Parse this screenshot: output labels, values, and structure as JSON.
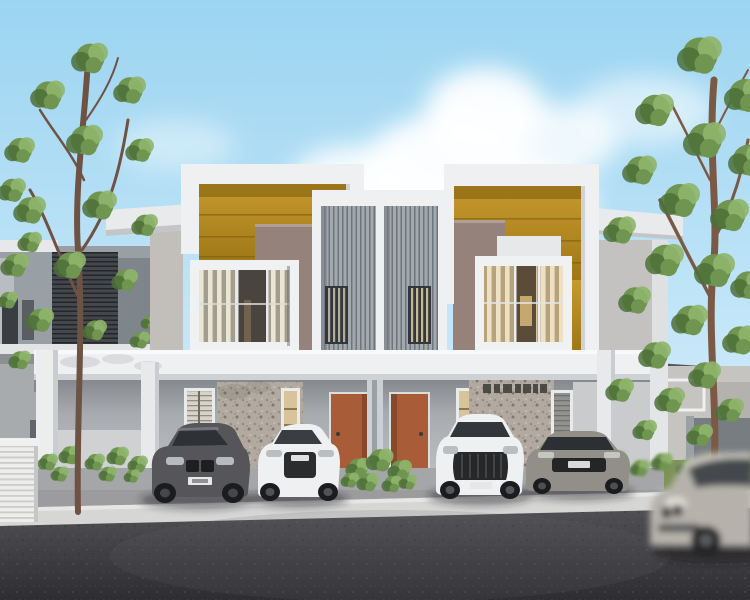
{
  "meta": {
    "subject": "3D architectural rendering of a modern two-storey terrace duplex with gold parapet accents, central vertical louver screens, four parked cars and a motion-blurred passing car",
    "setting": "daytime, blue sky with cumulus cloud, trees flanking both sides, asphalt street in foreground"
  },
  "palette": {
    "sky_top": "#9bd4f1",
    "sky_mid": "#c4e6f8",
    "sky_horizon": "#e4f1fb",
    "cloud": "#ffffff",
    "gold_accent": "#bb8d22",
    "gold_shadow": "#8a6712",
    "taupe_wall": "#95827a",
    "taupe_dark": "#7c6c64",
    "white_wall": "#eff0f2",
    "white_shadow": "#cfd2d5",
    "louver_light": "#a2a9af",
    "louver_dark": "#6e767d",
    "stone_wall": "#b2aaa0",
    "porch_wall": "#a7abaf",
    "porch_shadow": "#85898e",
    "door": "#a85c38",
    "door_shade": "#7e4527",
    "window_glass": "#4d5257",
    "curtain_warm": "#e8dcc0",
    "foliage": "#6f9550",
    "foliage_dark": "#4e7038",
    "foliage_light": "#8fb56c",
    "trunk": "#6e5244",
    "driveway": "#9c9c9e",
    "curb": "#d6d6d4",
    "asphalt_light": "#515155",
    "asphalt_dark": "#2e2e32",
    "car_dark_gray": "#55555a",
    "car_white": "#eef0f2",
    "car_silver": "#918f88",
    "car_blur_silver": "#b6b2ab",
    "tyre": "#1b1c1f",
    "shadow": "#222428"
  },
  "buildings": {
    "main": {
      "units": [
        {
          "label": "left duplex unit",
          "features": [
            "white parapet frame",
            "gold feature wall",
            "taupe wall",
            "boxed picture window with curtains",
            "terracotta entry door",
            "pebble stone feature wall"
          ]
        },
        {
          "label": "right duplex unit",
          "features": [
            "white parapet frame",
            "gold feature wall",
            "taupe wall",
            "boxed picture window with lit curtains",
            "terracotta entry door",
            "pebble stone feature wall with dark lettering"
          ]
        }
      ],
      "center_feature": "two vertical louver screen panels with slatted windows",
      "ground": "covered car porch with white square columns"
    },
    "neighbors": [
      {
        "label": "left neighbor house",
        "features": [
          "dark horizontal louver band",
          "gray walls",
          "white AC louver cabinet"
        ]
      },
      {
        "label": "right neighbor houses",
        "features": [
          "light walls",
          "white balcony frame",
          "gold fascia strip",
          "gray boundary fence"
        ]
      }
    ]
  },
  "vehicles": [
    {
      "label": "dark gray coupe",
      "state": "parked",
      "has_plate": true
    },
    {
      "label": "white sedan",
      "state": "parked",
      "has_plate": true
    },
    {
      "label": "white luxury SUV",
      "state": "parked",
      "has_plate": true
    },
    {
      "label": "silver sports coupe",
      "state": "parked",
      "has_plate": true
    },
    {
      "label": "silver car",
      "state": "driving past, motion blurred",
      "has_plate": false
    }
  ],
  "landscape": [
    "tall sparse tree left",
    "dense tree right",
    "central green bush",
    "hedge row right",
    "shrub bed left",
    "slim background trees"
  ]
}
